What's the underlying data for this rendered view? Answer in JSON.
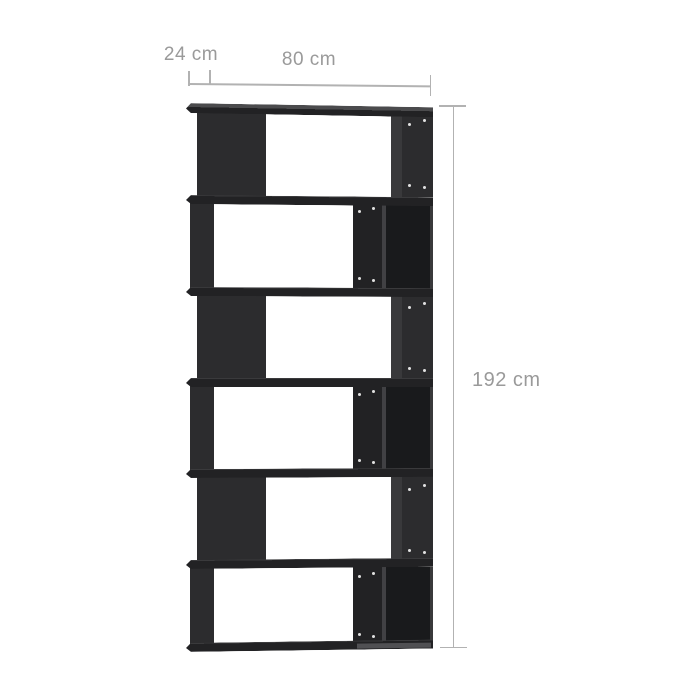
{
  "image": {
    "description": "Product dimension diagram: dark grey 6-tier zigzag book cabinet / room divider on white background",
    "background_color": "#ffffff"
  },
  "dimensions": {
    "depth": {
      "label": "24 cm"
    },
    "width": {
      "label": "80 cm"
    },
    "height": {
      "label": "192 cm"
    }
  },
  "bookcase": {
    "tier_count": 6,
    "tier_pattern": [
      "solid-panel-left / open-middle / screw-panel-right",
      "thin-wall-left / open-middle / screw-partition / dark-compartment-right",
      "solid-panel-left / open-middle / screw-panel-right",
      "thin-wall-left / open-middle / screw-partition / dark-compartment-right",
      "solid-panel-left / open-middle / screw-panel-right",
      "thin-wall-left / open-middle / screw-partition / dark-compartment-right"
    ],
    "screw_holes_per_tier": 4
  },
  "style": {
    "background_color": "#ffffff",
    "annotation_line_color": "#b2b2b2",
    "annotation_text_color": "#9a9a9a",
    "panel_color": "#2c2c2e",
    "panel_dark_color": "#222224",
    "interior_color": "#191a1c",
    "shadow_strip_color": "#39393b",
    "seam_color": "#414144",
    "top_face_color": "#4b4b4d",
    "bottom_face_color": "#505053",
    "screw_hole_color": "#f2f2f2"
  }
}
